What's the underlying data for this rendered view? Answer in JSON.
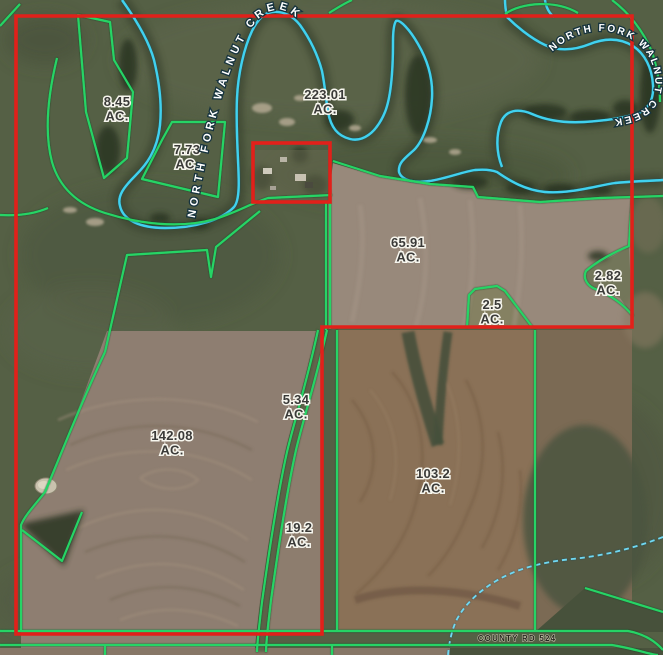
{
  "map": {
    "canvas": {
      "width": 663,
      "height": 655
    },
    "parcels": [
      {
        "name": "parcel-8-45",
        "acres": "8.45",
        "unit": "AC.",
        "x": 117,
        "y": 106
      },
      {
        "name": "parcel-7-73",
        "acres": "7.73",
        "unit": "AC.",
        "x": 187,
        "y": 154
      },
      {
        "name": "parcel-223-01",
        "acres": "223.01",
        "unit": "AC.",
        "x": 325,
        "y": 99
      },
      {
        "name": "parcel-65-91",
        "acres": "65.91",
        "unit": "AC.",
        "x": 408,
        "y": 247
      },
      {
        "name": "parcel-2-82",
        "acres": "2.82",
        "unit": "AC.",
        "x": 608,
        "y": 280
      },
      {
        "name": "parcel-2-5",
        "acres": "2.5",
        "unit": "AC.",
        "x": 492,
        "y": 309
      },
      {
        "name": "parcel-5-34",
        "acres": "5.34",
        "unit": "AC.",
        "x": 296,
        "y": 404
      },
      {
        "name": "parcel-142-08",
        "acres": "142.08",
        "unit": "AC.",
        "x": 172,
        "y": 440
      },
      {
        "name": "parcel-19-2",
        "acres": "19.2",
        "unit": "AC.",
        "x": 299,
        "y": 532
      },
      {
        "name": "parcel-103-2",
        "acres": "103.2",
        "unit": "AC.",
        "x": 433,
        "y": 478
      }
    ],
    "creek_labels": [
      {
        "text": "NORTH FORK WALNUT CREEK",
        "placement": "west"
      },
      {
        "text": "NORTH FORK WALNUT CREEK",
        "placement": "east"
      }
    ],
    "road_label": "COUNTY RD 524",
    "colors": {
      "boundary_red": "#e2201a",
      "parcel_green": "#27d465",
      "water_cyan": "#3fd1ef"
    }
  }
}
